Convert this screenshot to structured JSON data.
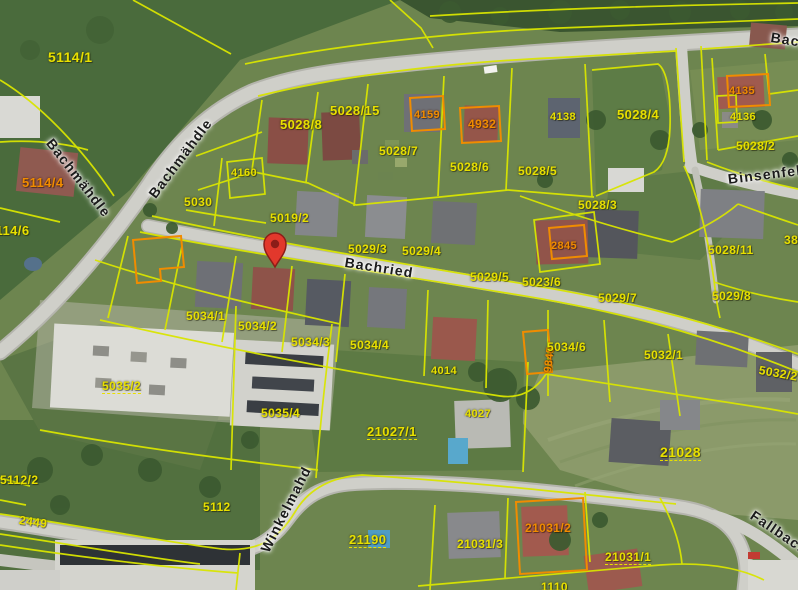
{
  "map": {
    "colors": {
      "boundary": "#d9e500",
      "highlight": "#f08c00",
      "parcel_label": "#e8e000",
      "street_label": "#1b1b1b",
      "pin": "#e2382c",
      "road": "#cfcfc9",
      "grass_dark": "#4c6a3b",
      "grass_light": "#8d9c6c"
    },
    "pin": {
      "x": 275,
      "y": 268
    },
    "streets": [
      {
        "name": "Bachmähdle",
        "x": 55,
        "y": 136,
        "r": 52
      },
      {
        "name": "Bachmähdle",
        "x": 146,
        "y": 192,
        "r": -53
      },
      {
        "name": "Bachried",
        "x": 346,
        "y": 255,
        "r": 9
      },
      {
        "name": "Binsenfeld",
        "x": 727,
        "y": 172,
        "r": -7
      },
      {
        "name": "Winkelmahd",
        "x": 258,
        "y": 548,
        "r": -63
      },
      {
        "name": "Fallbach",
        "x": 756,
        "y": 508,
        "r": 34
      },
      {
        "name": "Bach",
        "x": 772,
        "y": 30,
        "r": 9
      }
    ],
    "parcel_labels": [
      {
        "t": "5114/1",
        "x": 48,
        "y": 50,
        "c": "y",
        "s": 14
      },
      {
        "t": "5114/4",
        "x": 22,
        "y": 176,
        "c": "o",
        "s": 13
      },
      {
        "t": "5114/6",
        "x": -12,
        "y": 224,
        "c": "y",
        "s": 13
      },
      {
        "t": "5028/8",
        "x": 280,
        "y": 118,
        "c": "y",
        "s": 13
      },
      {
        "t": "5028/15",
        "x": 330,
        "y": 104,
        "c": "y",
        "s": 13
      },
      {
        "t": "4159",
        "x": 414,
        "y": 110,
        "c": "o",
        "s": 11
      },
      {
        "t": "4932",
        "x": 468,
        "y": 118,
        "c": "o",
        "s": 12
      },
      {
        "t": "4138",
        "x": 550,
        "y": 112,
        "c": "y",
        "s": 11
      },
      {
        "t": "5028/4",
        "x": 617,
        "y": 108,
        "c": "y",
        "s": 13
      },
      {
        "t": "4135",
        "x": 729,
        "y": 86,
        "c": "o",
        "s": 11
      },
      {
        "t": "4136",
        "x": 730,
        "y": 112,
        "c": "y",
        "s": 11
      },
      {
        "t": "5028/7",
        "x": 379,
        "y": 145,
        "c": "y",
        "s": 12
      },
      {
        "t": "5028/6",
        "x": 450,
        "y": 161,
        "c": "y",
        "s": 12
      },
      {
        "t": "5028/5",
        "x": 518,
        "y": 165,
        "c": "y",
        "s": 12
      },
      {
        "t": "5028/2",
        "x": 736,
        "y": 140,
        "c": "y",
        "s": 12
      },
      {
        "t": "5028/3",
        "x": 578,
        "y": 199,
        "c": "y",
        "s": 12
      },
      {
        "t": "5030",
        "x": 184,
        "y": 196,
        "c": "y",
        "s": 12
      },
      {
        "t": "4160",
        "x": 231,
        "y": 168,
        "c": "y",
        "s": 11
      },
      {
        "t": "5019/2",
        "x": 270,
        "y": 212,
        "c": "y",
        "s": 12
      },
      {
        "t": "5029/3",
        "x": 348,
        "y": 243,
        "c": "y",
        "s": 12
      },
      {
        "t": "5029/4",
        "x": 402,
        "y": 245,
        "c": "y",
        "s": 12
      },
      {
        "t": "5029/5",
        "x": 470,
        "y": 271,
        "c": "y",
        "s": 12
      },
      {
        "t": "5023/6",
        "x": 522,
        "y": 276,
        "c": "y",
        "s": 12
      },
      {
        "t": "2845",
        "x": 551,
        "y": 241,
        "c": "o",
        "s": 11
      },
      {
        "t": "5029/7",
        "x": 598,
        "y": 292,
        "c": "y",
        "s": 12
      },
      {
        "t": "5028/11",
        "x": 708,
        "y": 244,
        "c": "y",
        "s": 12
      },
      {
        "t": "385",
        "x": 784,
        "y": 234,
        "c": "y",
        "s": 12
      },
      {
        "t": "5029/8",
        "x": 712,
        "y": 290,
        "c": "y",
        "s": 12
      },
      {
        "t": "5034/1",
        "x": 186,
        "y": 310,
        "c": "y",
        "s": 12
      },
      {
        "t": "5034/2",
        "x": 238,
        "y": 320,
        "c": "y",
        "s": 12
      },
      {
        "t": "5034/3",
        "x": 291,
        "y": 336,
        "c": "y",
        "s": 12
      },
      {
        "t": "5034/4",
        "x": 350,
        "y": 339,
        "c": "y",
        "s": 12
      },
      {
        "t": "9845",
        "x": 543,
        "y": 372,
        "c": "o",
        "s": 11,
        "r": -83
      },
      {
        "t": "5034/6",
        "x": 547,
        "y": 341,
        "c": "y",
        "s": 12
      },
      {
        "t": "5032/1",
        "x": 644,
        "y": 349,
        "c": "y",
        "s": 12
      },
      {
        "t": "5032/2",
        "x": 760,
        "y": 364,
        "c": "y",
        "s": 12,
        "r": 10
      },
      {
        "t": "5035/2",
        "x": 102,
        "y": 380,
        "c": "y",
        "s": 12,
        "u": true
      },
      {
        "t": "5035/4",
        "x": 261,
        "y": 407,
        "c": "y",
        "s": 12
      },
      {
        "t": "4014",
        "x": 431,
        "y": 366,
        "c": "y",
        "s": 11
      },
      {
        "t": "4027",
        "x": 465,
        "y": 409,
        "c": "y",
        "s": 11
      },
      {
        "t": "21027/1",
        "x": 367,
        "y": 425,
        "c": "y",
        "s": 13,
        "u": true
      },
      {
        "t": "21028",
        "x": 660,
        "y": 445,
        "c": "y",
        "s": 14,
        "u": true
      },
      {
        "t": "5112/2",
        "x": 0,
        "y": 474,
        "c": "y",
        "s": 12
      },
      {
        "t": "2449",
        "x": 20,
        "y": 514,
        "c": "y",
        "s": 12,
        "r": 8
      },
      {
        "t": "5112",
        "x": 203,
        "y": 501,
        "c": "y",
        "s": 12
      },
      {
        "t": "21190",
        "x": 349,
        "y": 533,
        "c": "y",
        "s": 13,
        "u": true
      },
      {
        "t": "21031/3",
        "x": 457,
        "y": 538,
        "c": "y",
        "s": 12
      },
      {
        "t": "21031/2",
        "x": 525,
        "y": 522,
        "c": "o",
        "s": 12
      },
      {
        "t": "21031/1",
        "x": 605,
        "y": 551,
        "c": "y",
        "s": 12,
        "u": true
      },
      {
        "t": "1110",
        "x": 541,
        "y": 581,
        "c": "y",
        "s": 12
      }
    ]
  }
}
